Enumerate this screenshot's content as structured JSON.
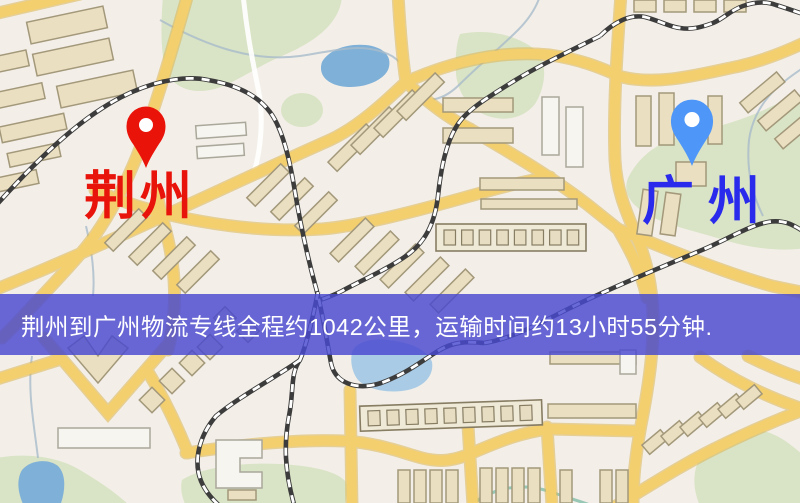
{
  "banner": {
    "text": "荆州到广州物流专线全程约1042公里，运输时间约13小时55分钟.",
    "bg_color": "rgba(72,72,208,0.82)",
    "text_color": "#ffffff"
  },
  "origin": {
    "name": "荆州",
    "pin_color": "#ea130a",
    "label_color": "#e8130b"
  },
  "destination": {
    "name": "广州",
    "pin_color": "#4e96f8",
    "label_color": "#2a2aec"
  },
  "route": {
    "distance": "1042公里",
    "duration": "13小时55分钟"
  },
  "map_colors": {
    "background": "#f3efe8",
    "road": "#f4cf6e",
    "water": "#7fb0d8",
    "park": "#d9e3c5",
    "railway": "#3c3c3c"
  }
}
